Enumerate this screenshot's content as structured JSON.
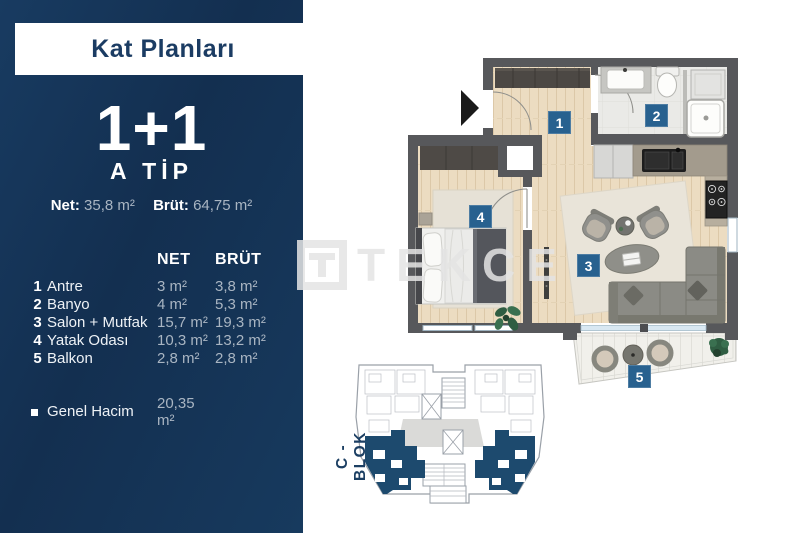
{
  "header": {
    "title": "Kat Planları"
  },
  "unit": {
    "type": "1+1",
    "tip": "A TİP",
    "net_label": "Net:",
    "net_value": "35,8 m²",
    "brut_label": "Brüt:",
    "brut_value": "64,75 m²"
  },
  "table": {
    "col_net": "NET",
    "col_brut": "BRÜT",
    "rows": [
      {
        "no": "1",
        "name": "Antre",
        "net": "3 m²",
        "brut": "3,8 m²"
      },
      {
        "no": "2",
        "name": "Banyo",
        "net": "4 m²",
        "brut": "5,3 m²"
      },
      {
        "no": "3",
        "name": "Salon + Mutfak",
        "net": "15,7 m²",
        "brut": "19,3 m²"
      },
      {
        "no": "4",
        "name": "Yatak Odası",
        "net": "10,3 m²",
        "brut": "13,2 m²"
      },
      {
        "no": "5",
        "name": "Balkon",
        "net": "2,8 m²",
        "brut": "2,8 m²"
      }
    ],
    "total_label": "Genel Hacim",
    "total_value": "20,35 m²"
  },
  "plan": {
    "badges": [
      "1",
      "2",
      "3",
      "4",
      "5"
    ]
  },
  "block": {
    "label": "C - BLOK"
  },
  "watermark": {
    "text": "TEKCE"
  },
  "colors": {
    "sidebar_navy": "#15365a",
    "badge_blue": "#28618f",
    "block_highlight": "#1d4a6e",
    "title_navy": "#1b3c63",
    "wall_gray": "#57585b"
  }
}
